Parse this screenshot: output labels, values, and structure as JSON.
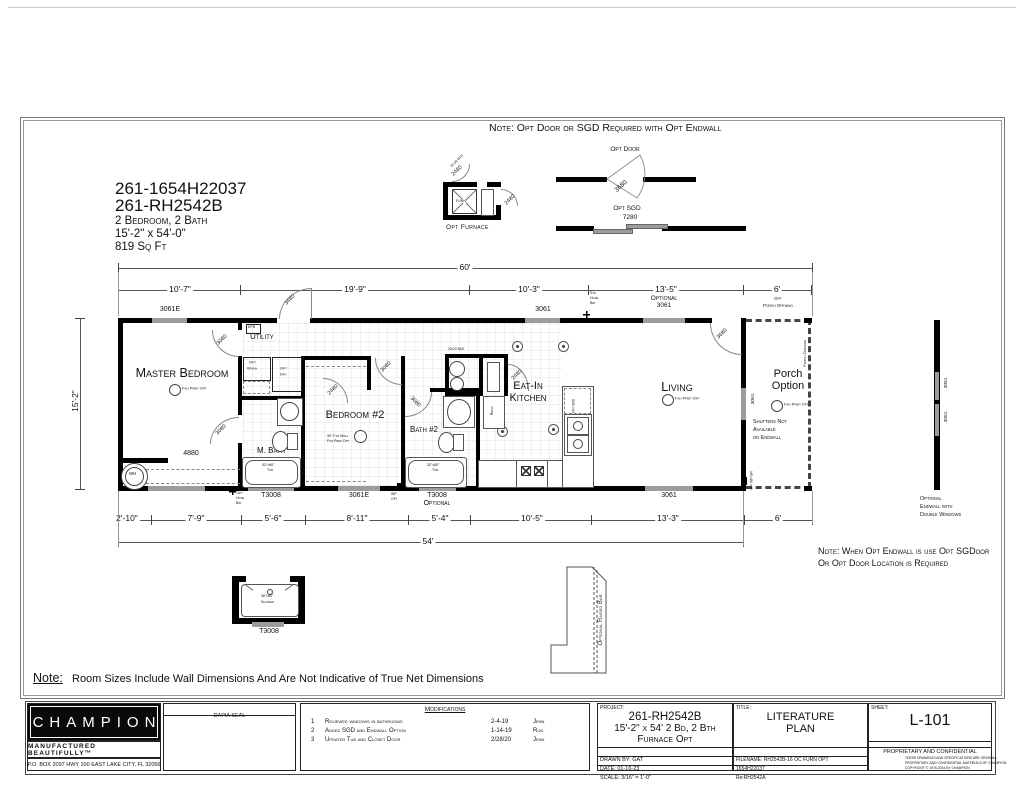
{
  "colors": {
    "wall": "#000000",
    "window": "#9c9c9c",
    "line": "#555555"
  },
  "notes": {
    "top": "Note: Opt Door or SGD Required with Opt Endwall",
    "endwall1": "Note: When Opt Endwall is use Opt SGDoor",
    "endwall2": "Or Opt Door Location is Required",
    "bottom_label": "Note:",
    "bottom_text": "Room Sizes Include Wall Dimensions And Are Not Indicative of True Net Dimensions"
  },
  "plan_info": {
    "model1": "261-1654H22037",
    "model2": "261-RH2542B",
    "beds": "2 Bedroom, 2 Bath",
    "size": "15'-2\" x 54'-0\"",
    "area": "819 Sq Ft"
  },
  "details": {
    "furnace_label": "Opt Furnace",
    "furn": "FURN",
    "opt_door_label": "Opt Door",
    "opt_door_size": "3680",
    "opt_sgd_label": "Opt SGD",
    "opt_sgd_size": "7280",
    "shower_size": "36\"x60\"",
    "shower_name": "Shower",
    "shower_tag": "T3008",
    "raised_bar": "Optional Raised Bar",
    "endwall1": "Optional",
    "endwall2": "Endwall with",
    "endwall3": "Double Windows"
  },
  "dims": {
    "top_total": "60'",
    "bottom_total": "54'",
    "left": "15'-2\"",
    "top": [
      "10'-7\"",
      "19'-9\"",
      "10'-3\"",
      "13'-5\"",
      "6'"
    ],
    "bottom": [
      "2'-10\"",
      "7'-9\"",
      "5'-6\"",
      "8'-11\"",
      "5'-4\"",
      "10'-5\"",
      "13'-3\"",
      "6'"
    ]
  },
  "rooms": {
    "master": "Master Bedroom",
    "utility": "Utility",
    "bedroom2": "Bedroom #2",
    "mbath": "M. Bath",
    "bath2": "Bath #2",
    "kitchen1": "Eat-In",
    "kitchen2": "Kitchen",
    "living": "Living",
    "porch1": "Porch",
    "porch2": "Option"
  },
  "labels": {
    "w3061e": "3061E",
    "w3061": "3061",
    "w4880": "4880",
    "t3008": "T3008",
    "optional": "Optional",
    "d3080": "3080",
    "d2480": "2480",
    "d3480": "3480",
    "d3680": "3680",
    "fan_prep": "Fan Prep Opt",
    "fan30": "30\" Fan Wall",
    "tub_size": "32\"x60\"",
    "tub": "Tub",
    "wh": "WH",
    "epb": "EPB",
    "refr": "Refr",
    "opt_wd": "Opt W/D",
    "opt": "Opt",
    "std": "Std",
    "wash": "Wash",
    "dry": "Dry",
    "hose": "Hose",
    "bib": "Bib",
    "wp": "WP",
    "gfi": "GFI",
    "opt_wp_gfi": "Opt WP GFI",
    "bag": "20x20 BAG",
    "porch_opening": "Porch Opening",
    "shutters1": "Shutters Not",
    "shutters2": "Available",
    "shutters3": "on Endwall"
  },
  "title_block": {
    "brand": "CHAMPION",
    "tagline": "MANUFACTURED BEAUTIFULLY™",
    "address": "P.O. BOX 2097 HWY 100 EAST LAKE CITY, FL  32056",
    "dapia": "DAPIA SEAL",
    "mods_header": "Modifications",
    "mods": [
      {
        "num": "1",
        "desc": "Reviewed windows in bathrooms",
        "date": "2-4-19",
        "by": "Jenn"
      },
      {
        "num": "2",
        "desc": "Added SGD and Endwall Option",
        "date": "1-14-19",
        "by": "Rod"
      },
      {
        "num": "3",
        "desc": "Updated Tub and Closet Door",
        "date": "2/28/20",
        "by": "Jenn"
      }
    ],
    "project_label": "PROJECT:",
    "project1": "261-RH2542B",
    "project2": "15'-2\" x 54' 2 Bd, 2 Bth",
    "project3": "Furnace Opt",
    "drawn_by": "DRAWN BY: GAT",
    "date": "DATE: 01-16-23",
    "scale": "SCALE: 3/16\" = 1'-0\"",
    "title_label": "TITLE:",
    "title1": "LITERATURE",
    "title2": "PLAN",
    "filename": "FILENAME: RH2542B-16 OC FURN OPT",
    "file2": "1654H22037",
    "file3": "Re:RH2542A",
    "sheet_label": "SHEET:",
    "sheet": "L-101",
    "conf_head": "PROPRIETARY AND CONFIDENTIAL",
    "conf1": "THESE DRAWINGS AND SPECIFICATIONS ARE ORIGINAL,",
    "conf2": "PROPRIETARY AND CONFIDENTIAL MATERIALS OF CHAMPION.",
    "conf3": "COPYRIGHT © 1976-2024 BY CHAMPION"
  }
}
